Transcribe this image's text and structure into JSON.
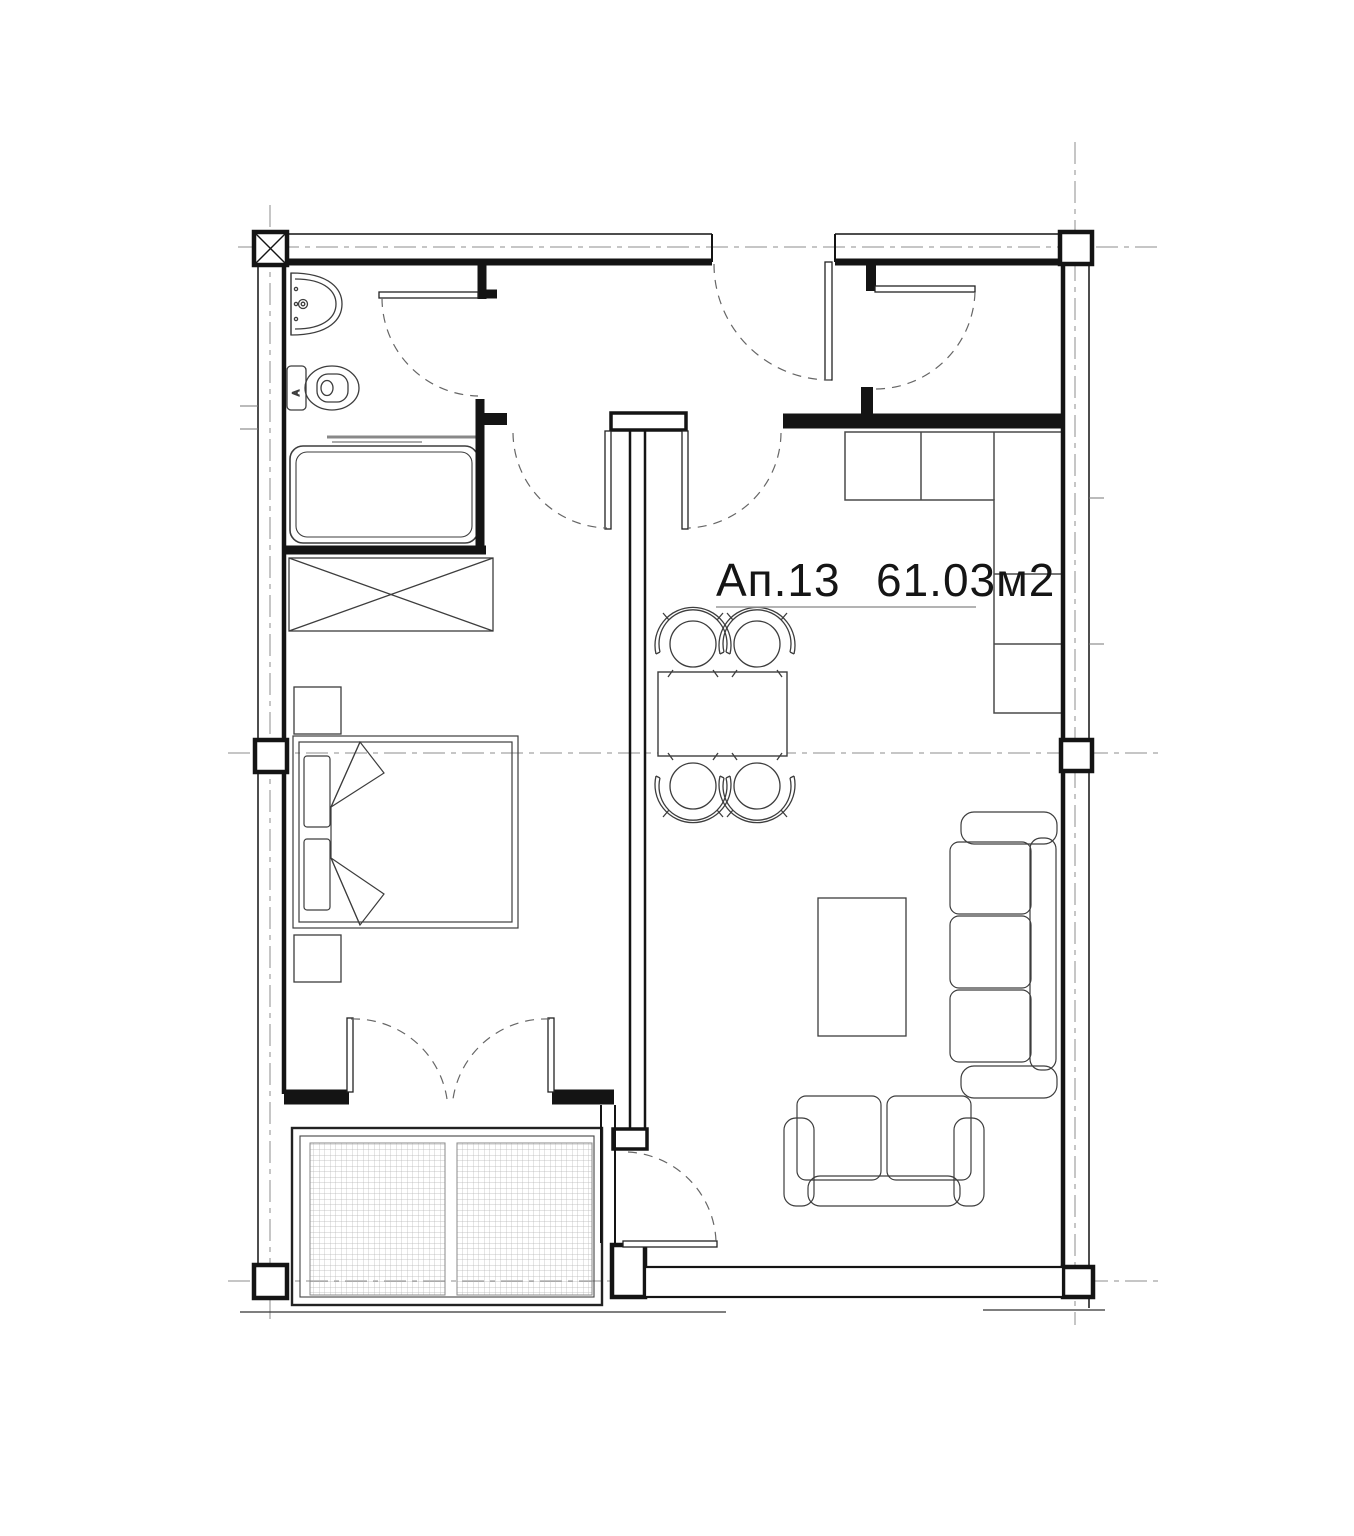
{
  "plan": {
    "apartment_label": "Ап.13",
    "area_label": "61.03м2",
    "toilet_marker": "A",
    "colors": {
      "background": "#ffffff",
      "walls": "#141414",
      "axis_lines": "#8c8c8c",
      "door_arcs": "#666666",
      "furniture": "#3d3d3d",
      "hatch": "#b5b5b5",
      "underline": "#9a9a9a"
    },
    "fixtures": [
      "sink",
      "toilet",
      "bathtub",
      "wardrobe-crossed",
      "double-bed",
      "nightstand",
      "dining-table",
      "dining-chairs",
      "kitchen-counter",
      "sofa-3-seat",
      "sofa-2-seat",
      "coffee-table",
      "balcony-glazing",
      "entry-door",
      "bathroom-door",
      "bedroom-door",
      "living-room-door",
      "storage-door",
      "french-doors",
      "balcony-door"
    ]
  }
}
